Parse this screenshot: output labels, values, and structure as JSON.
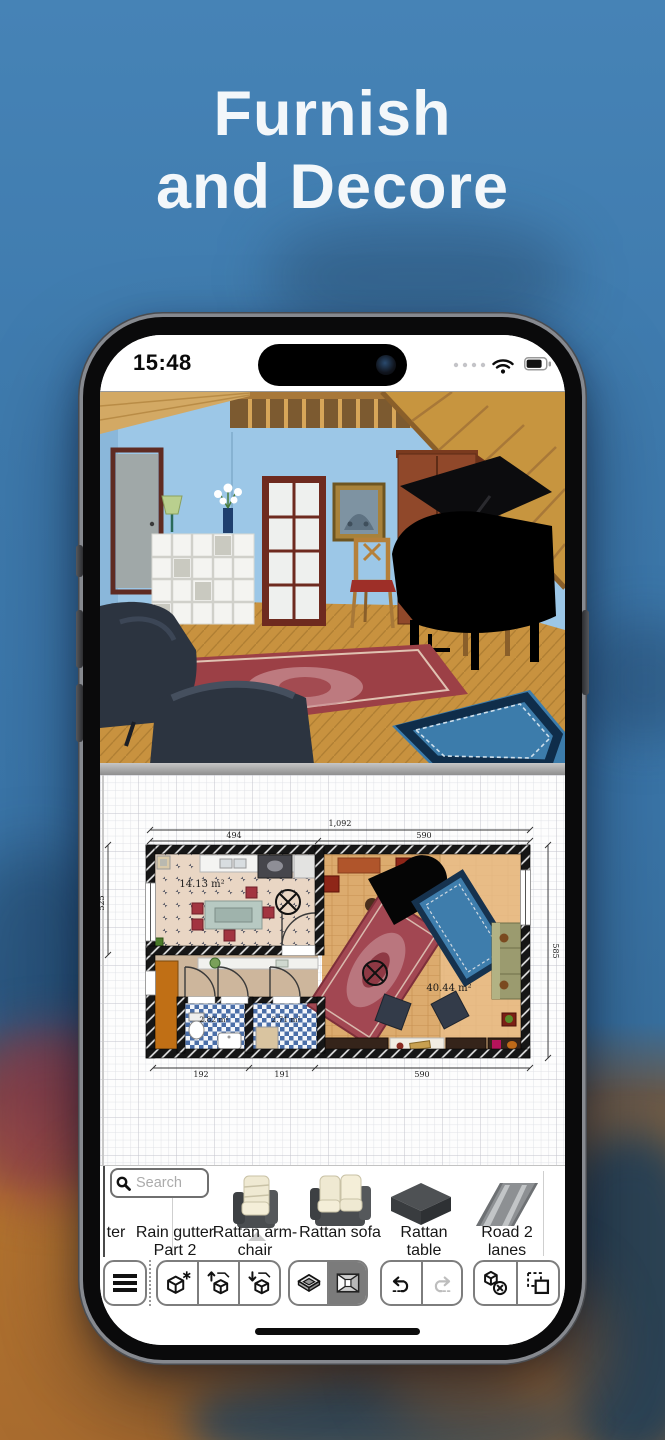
{
  "headline": {
    "line1": "Furnish",
    "line2": "and Decore"
  },
  "statusbar": {
    "time": "15:48"
  },
  "colors": {
    "background_blue": "#3a75a8",
    "wall_blue_3d": "#9cc7e7",
    "floor_wood": "#c8923f",
    "plan_wall": "#141414",
    "active_button_grey": "#7b7b7b"
  },
  "plan": {
    "dims": {
      "total": "1,092",
      "top_left": "494",
      "top_right": "590",
      "side_left": "525",
      "side_right": "585",
      "bottom_1": "192",
      "bottom_2": "191",
      "bottom_3": "590"
    },
    "areas": {
      "kitchen": "14.13 m²",
      "bath1": "2.82 m²",
      "bath2": "2.71 m²",
      "living": "40.44 m²"
    }
  },
  "catalog": {
    "search_placeholder": "Search",
    "items": [
      {
        "line1": "ter",
        "line2": "",
        "icon": "truncated-item"
      },
      {
        "line1": "Rain gutter",
        "line2": "Part 2",
        "icon": "rain-gutter"
      },
      {
        "line1": "Rattan arm-",
        "line2": "chair",
        "icon": "rattan-armchair"
      },
      {
        "line1": "",
        "line2": "Rattan sofa",
        "icon": "rattan-sofa"
      },
      {
        "line1": "Rattan",
        "line2": "table",
        "icon": "rattan-table"
      },
      {
        "line1": "Road 2",
        "line2": "lanes",
        "icon": "road-2-lanes"
      }
    ]
  },
  "toolbar": {
    "buttons": [
      "menu",
      "new-object",
      "export-3d-object",
      "import-3d-object",
      "view-2d",
      "view-3d-active",
      "undo",
      "redo",
      "delete-object",
      "select-copy"
    ]
  }
}
